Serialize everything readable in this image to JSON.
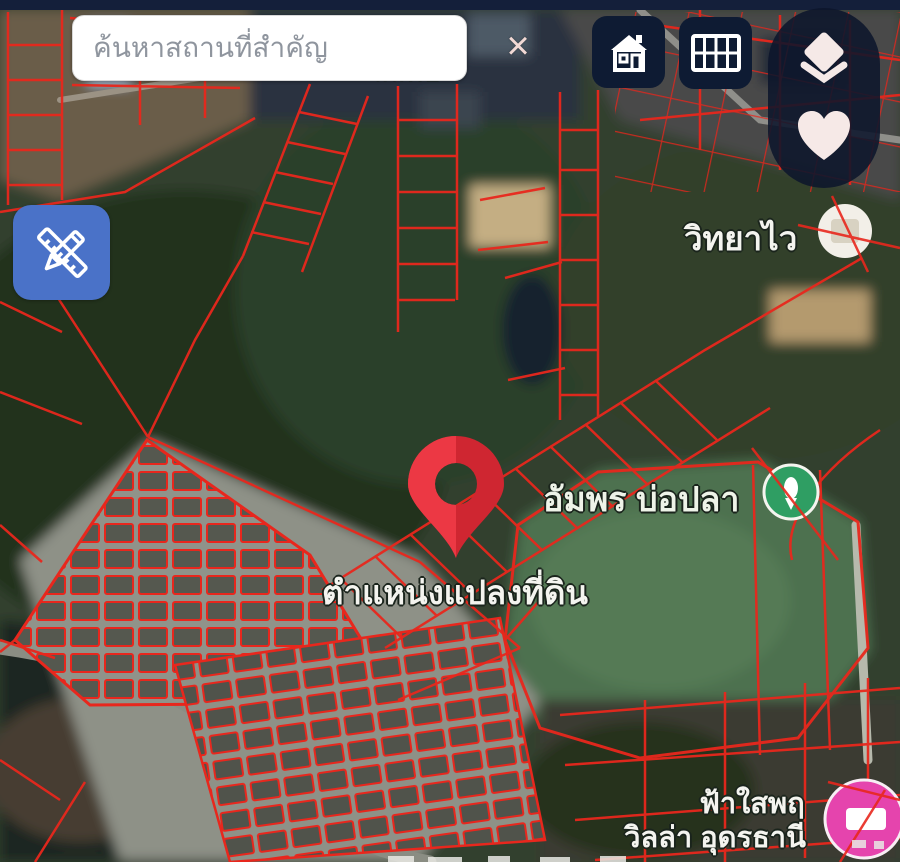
{
  "search": {
    "placeholder": "ค้นหาสถานที่สำคัญ",
    "clear_glyph": "×"
  },
  "marker": {
    "label": "ตำแหน่งแปลงที่ดิน"
  },
  "place_labels": {
    "school": "วิทยาไว",
    "fish_pond": "อัมพร บ่อปลา",
    "estate_line1": "ฟ้าใสพฤ",
    "estate_line2": "วิลล่า อุดรธานี",
    "occluded_top": "ลลที่บ"
  },
  "map_controls": {
    "home": "home-icon",
    "table": "table-grid-icon",
    "layers": "layers-icon",
    "favorites": "heart-icon",
    "measure": "ruler-pencil-icon",
    "clear_search": "close-icon"
  },
  "theme": {
    "parcel_line": "#e8271d",
    "pin_red": "#e2303c",
    "button_navy": "#0e1b33",
    "accent_blue": "#4a72c8",
    "top_bar": "#141f3a",
    "poi_green": "#2f9e63",
    "poi_pink": "#e544ad",
    "poi_white": "#f2efe8"
  }
}
